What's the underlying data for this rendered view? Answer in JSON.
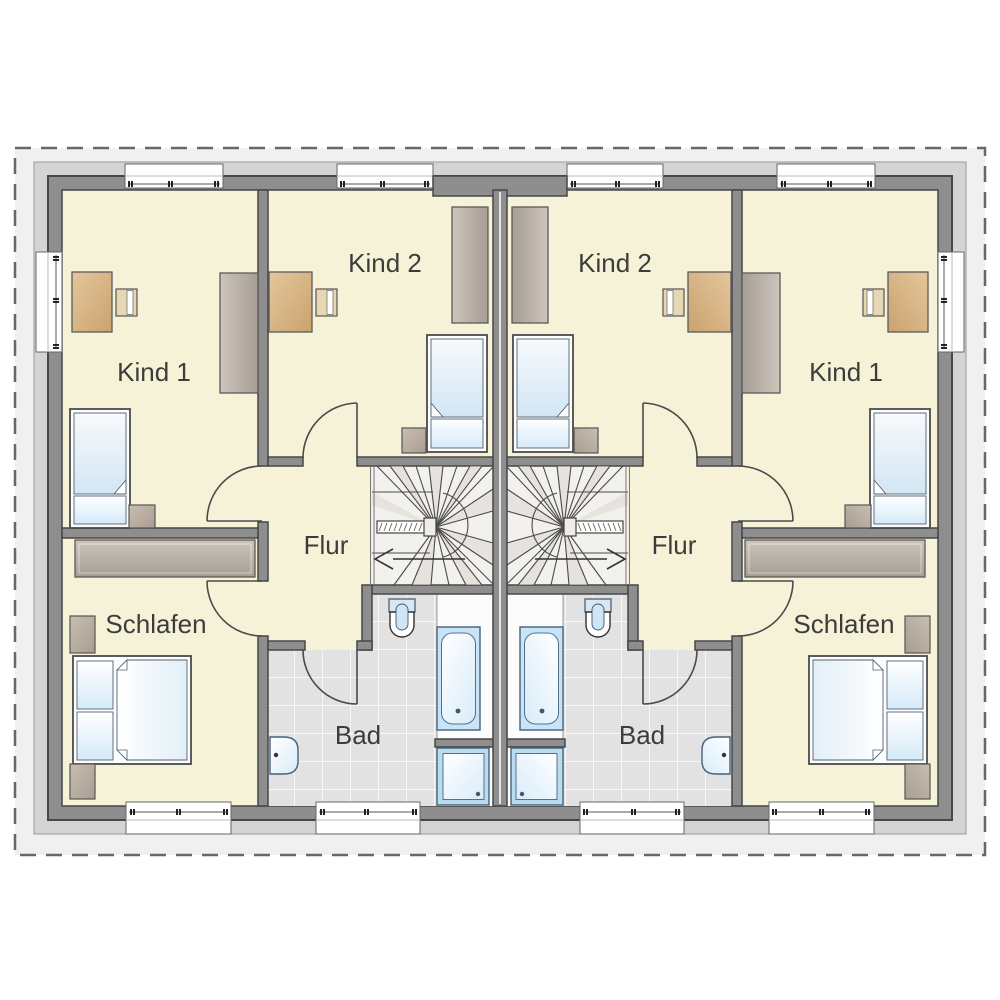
{
  "plan": {
    "type": "floor-plan",
    "units": [
      "left",
      "right"
    ],
    "mirrored": true,
    "rooms": {
      "kind1": "Kind 1",
      "kind2": "Kind 2",
      "flur": "Flur",
      "schlafen": "Schlafen",
      "bad": "Bad"
    },
    "fixtures": [
      "winder-staircase",
      "handrail",
      "direction-arrow",
      "single-bed",
      "double-bed",
      "desk",
      "desk-chair",
      "wardrobe",
      "nightstand",
      "bathtub",
      "shower",
      "toilet",
      "sink",
      "window",
      "door-swing",
      "roof-outline",
      "party-wall"
    ],
    "colors": {
      "floor_yellow": "#f6f2d8",
      "wall_gray": "#8e8e8e",
      "wall_outline": "#474747",
      "trim_gray": "#d4d4d4",
      "surround_gray": "#f0f0f0",
      "tile_gray": "#e2e2e2",
      "water_blue": "#cfe7f7",
      "wood_tan": "#d7b88a",
      "furniture_gray": "#b4aba1",
      "stair_floor": "#f3f1ee",
      "label_text": "#3c3c3c"
    }
  }
}
